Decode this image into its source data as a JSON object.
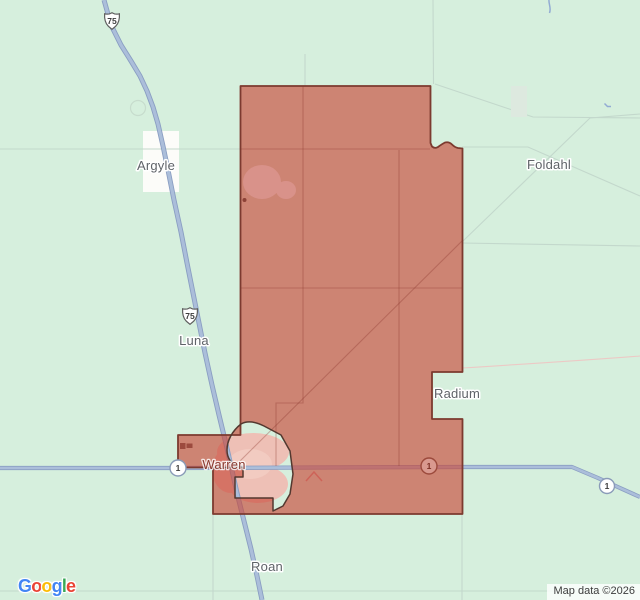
{
  "map": {
    "labels": {
      "argyle": "Argyle",
      "foldahl": "Foldahl",
      "luna": "Luna",
      "radium": "Radium",
      "warren": "Warren",
      "roan": "Roan"
    },
    "shields": {
      "us75": "75",
      "route1": "1"
    },
    "attribution": "Map data ©2026",
    "google_logo": {
      "letters": [
        {
          "char": "G",
          "color": "#4285F4"
        },
        {
          "char": "o",
          "color": "#EA4335"
        },
        {
          "char": "o",
          "color": "#FBBC05"
        },
        {
          "char": "g",
          "color": "#4285F4"
        },
        {
          "char": "l",
          "color": "#34A853"
        },
        {
          "char": "e",
          "color": "#EA4335"
        }
      ]
    },
    "colors": {
      "background_green": "#d6efdd",
      "polygon_fill": "rgba(199,74,59,0.65)",
      "polygon_outline": "#7c3a2f",
      "city_boundary": "#53382f",
      "road_blue": "#abbeda",
      "road_casing": "#8a9ec2",
      "warren_label": "#8a3a30",
      "place_label": "#5f6368"
    }
  }
}
